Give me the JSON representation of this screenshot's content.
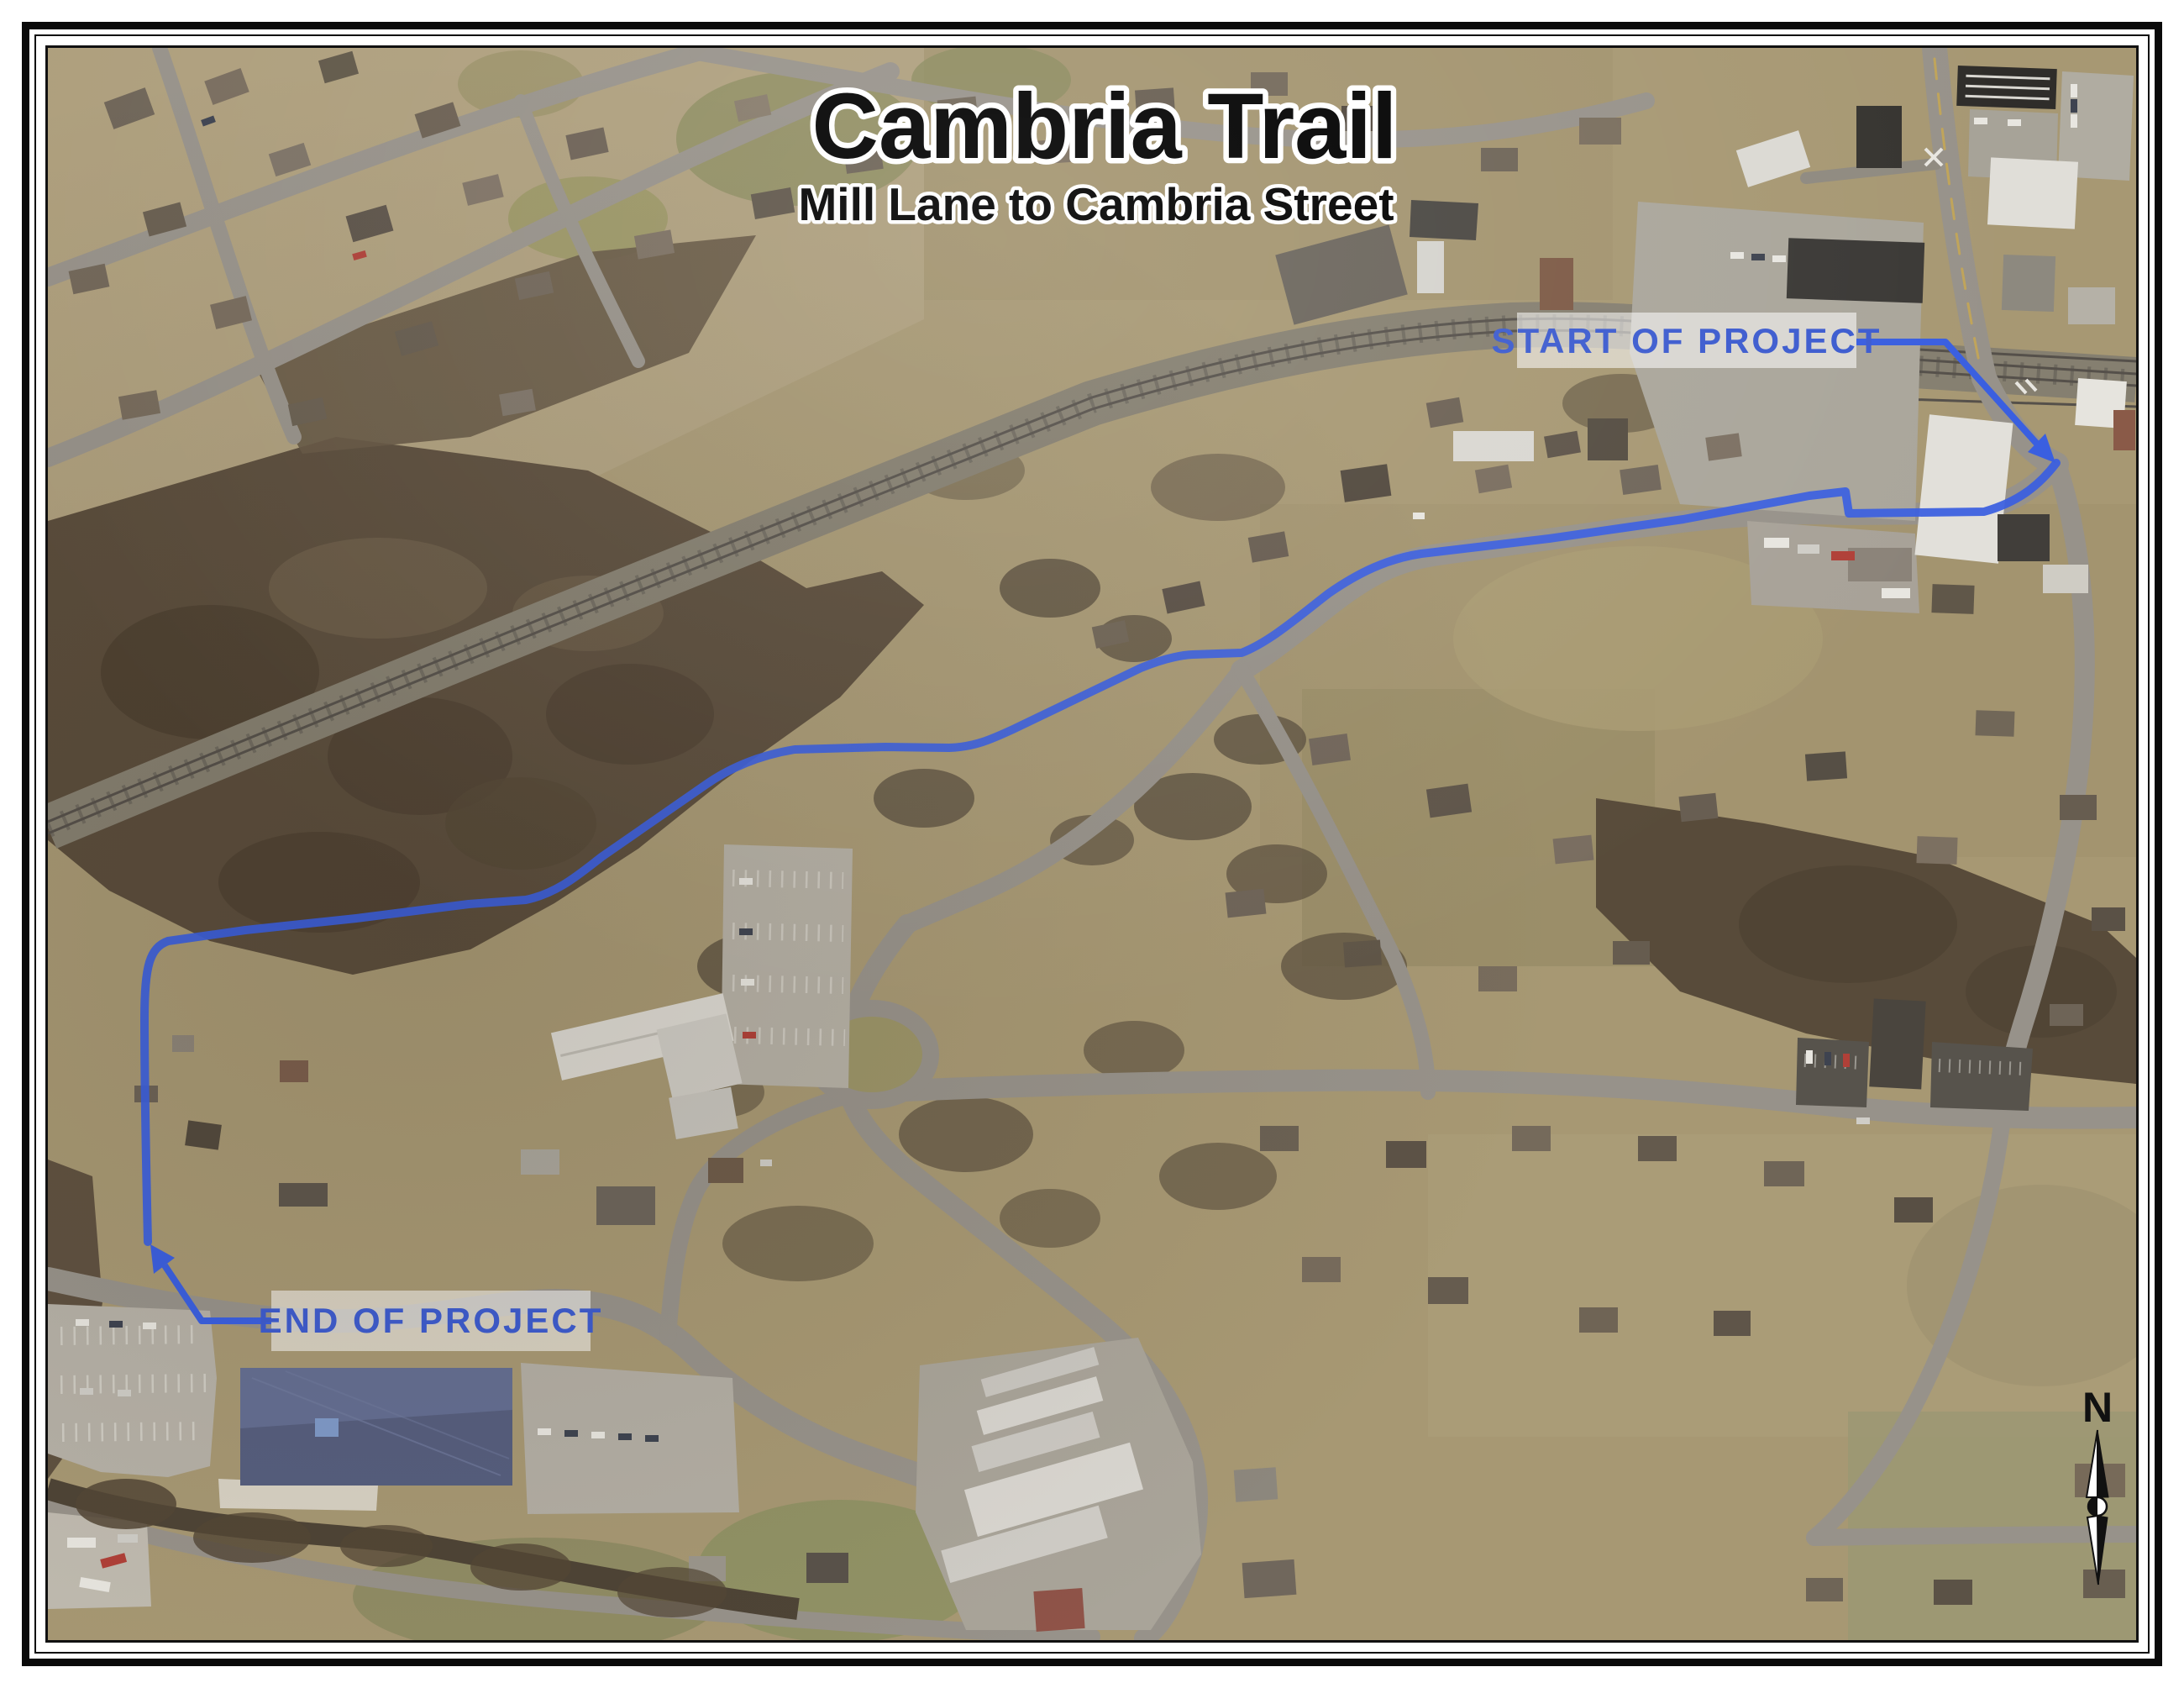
{
  "sheet": {
    "title": "Cambria Trail",
    "subtitle": "Mill Lane to Cambria Street"
  },
  "annotations": {
    "start_label": "START OF PROJECT",
    "end_label": "END OF PROJECT"
  },
  "compass": {
    "north_label": "N"
  },
  "colors": {
    "trail_blue": "#3a5fe0",
    "annotation_blue": "#3d5ccf",
    "annotation_box_bg": "rgba(255,255,255,0.55)",
    "title_fill": "#000000",
    "title_halo": "#ffffff"
  }
}
